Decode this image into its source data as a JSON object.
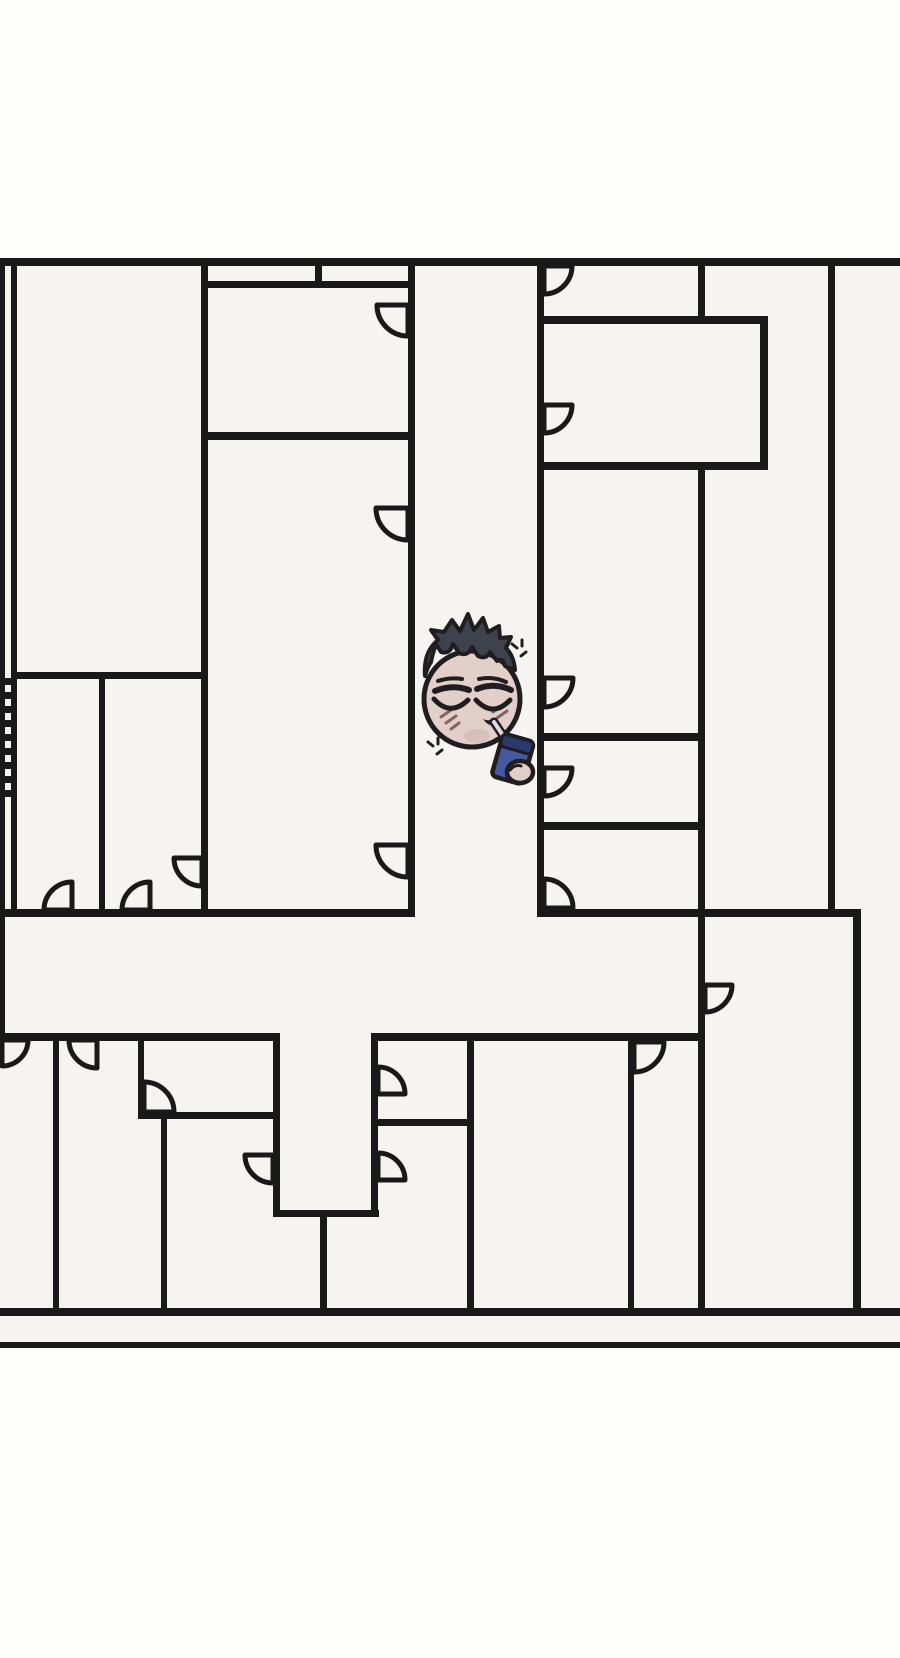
{
  "scene": {
    "width": 900,
    "height": 1658,
    "colors": {
      "outside": "#fdfdfc",
      "inside": "#f5f4f1",
      "wall": "#191919",
      "outline": "#201d20",
      "skin": "#e3cfca",
      "skin_shade": "#cdb5b1",
      "hair": "#3e424c",
      "blush": "#8a6168",
      "box_body": "#4559a2",
      "box_band": "#2b3a6e",
      "straw": "#dcdce2"
    }
  },
  "floorplan": {
    "inside": {
      "x": 0,
      "y": 258,
      "w": 900,
      "h": 1090
    },
    "h_walls": [
      {
        "x": 0,
        "y": 258,
        "w": 900,
        "h": 8
      },
      {
        "x": 205,
        "y": 281,
        "w": 205,
        "h": 7
      },
      {
        "x": 205,
        "y": 432,
        "w": 210,
        "h": 8
      },
      {
        "x": 11,
        "y": 672,
        "w": 196,
        "h": 7
      },
      {
        "x": 0,
        "y": 909,
        "w": 415,
        "h": 8
      },
      {
        "x": 537,
        "y": 909,
        "w": 324,
        "h": 8
      },
      {
        "x": 537,
        "y": 733,
        "w": 168,
        "h": 8
      },
      {
        "x": 537,
        "y": 822,
        "w": 168,
        "h": 8
      },
      {
        "x": 537,
        "y": 316,
        "w": 231,
        "h": 8
      },
      {
        "x": 537,
        "y": 462,
        "w": 231,
        "h": 8
      },
      {
        "x": 0,
        "y": 1033,
        "w": 280,
        "h": 8
      },
      {
        "x": 371,
        "y": 1033,
        "w": 334,
        "h": 8
      },
      {
        "x": 138,
        "y": 1112,
        "w": 140,
        "h": 7
      },
      {
        "x": 371,
        "y": 1119,
        "w": 103,
        "h": 7
      },
      {
        "x": 273,
        "y": 1210,
        "w": 106,
        "h": 7
      },
      {
        "x": 0,
        "y": 1308,
        "w": 900,
        "h": 8
      },
      {
        "x": 0,
        "y": 1342,
        "w": 900,
        "h": 6
      }
    ],
    "v_walls": [
      {
        "x": 0,
        "y": 258,
        "w": 5,
        "h": 784
      },
      {
        "x": 11,
        "y": 258,
        "w": 6,
        "h": 659
      },
      {
        "x": 99,
        "y": 675,
        "w": 6,
        "h": 242
      },
      {
        "x": 201,
        "y": 258,
        "w": 7,
        "h": 659
      },
      {
        "x": 315,
        "y": 262,
        "w": 7,
        "h": 26
      },
      {
        "x": 408,
        "y": 262,
        "w": 7,
        "h": 655
      },
      {
        "x": 537,
        "y": 262,
        "w": 7,
        "h": 655
      },
      {
        "x": 698,
        "y": 262,
        "w": 7,
        "h": 60
      },
      {
        "x": 698,
        "y": 466,
        "w": 7,
        "h": 850
      },
      {
        "x": 760,
        "y": 316,
        "w": 8,
        "h": 154
      },
      {
        "x": 828,
        "y": 262,
        "w": 7,
        "h": 655
      },
      {
        "x": 853,
        "y": 912,
        "w": 8,
        "h": 404
      },
      {
        "x": 53,
        "y": 1036,
        "w": 6,
        "h": 276
      },
      {
        "x": 138,
        "y": 1036,
        "w": 6,
        "h": 83
      },
      {
        "x": 161,
        "y": 1119,
        "w": 6,
        "h": 193
      },
      {
        "x": 273,
        "y": 1036,
        "w": 7,
        "h": 181
      },
      {
        "x": 320,
        "y": 1213,
        "w": 7,
        "h": 99
      },
      {
        "x": 371,
        "y": 1036,
        "w": 7,
        "h": 181
      },
      {
        "x": 467,
        "y": 1036,
        "w": 7,
        "h": 276
      },
      {
        "x": 628,
        "y": 1036,
        "w": 6,
        "h": 276
      }
    ],
    "door_arcs": [
      {
        "x": 2,
        "y": 1040,
        "r": 26,
        "q": "se"
      },
      {
        "x": 97,
        "y": 1040,
        "r": 28,
        "q": "sw"
      },
      {
        "x": 144,
        "y": 1112,
        "r": 30,
        "q": "ne"
      },
      {
        "x": 273,
        "y": 1155,
        "r": 28,
        "q": "sw"
      },
      {
        "x": 378,
        "y": 1094,
        "r": 27,
        "q": "ne"
      },
      {
        "x": 378,
        "y": 1180,
        "r": 27,
        "q": "ne"
      },
      {
        "x": 634,
        "y": 1042,
        "r": 30,
        "q": "se"
      },
      {
        "x": 705,
        "y": 985,
        "r": 27,
        "q": "se"
      },
      {
        "x": 72,
        "y": 910,
        "r": 28,
        "q": "nw"
      },
      {
        "x": 150,
        "y": 910,
        "r": 28,
        "q": "nw"
      },
      {
        "x": 202,
        "y": 858,
        "r": 28,
        "q": "sw"
      },
      {
        "x": 408,
        "y": 305,
        "r": 31,
        "q": "sw"
      },
      {
        "x": 408,
        "y": 508,
        "r": 32,
        "q": "sw"
      },
      {
        "x": 408,
        "y": 845,
        "r": 32,
        "q": "sw"
      },
      {
        "x": 544,
        "y": 266,
        "r": 28,
        "q": "se"
      },
      {
        "x": 544,
        "y": 405,
        "r": 28,
        "q": "se"
      },
      {
        "x": 544,
        "y": 678,
        "r": 29,
        "q": "se"
      },
      {
        "x": 544,
        "y": 768,
        "r": 28,
        "q": "se"
      },
      {
        "x": 544,
        "y": 908,
        "r": 29,
        "q": "ne"
      }
    ],
    "stairs": {
      "x": 0,
      "w": 11,
      "y_start": 678,
      "step": 14,
      "bar_h": 7,
      "count": 9
    }
  },
  "character": {
    "label": "tired-man-drinking-juice-box",
    "head": {
      "cx": 472,
      "cy": 699,
      "rx": 48,
      "ry": 48
    },
    "sparkles": [
      {
        "cx": 520,
        "cy": 650
      },
      {
        "cx": 436,
        "cy": 748
      }
    ]
  }
}
